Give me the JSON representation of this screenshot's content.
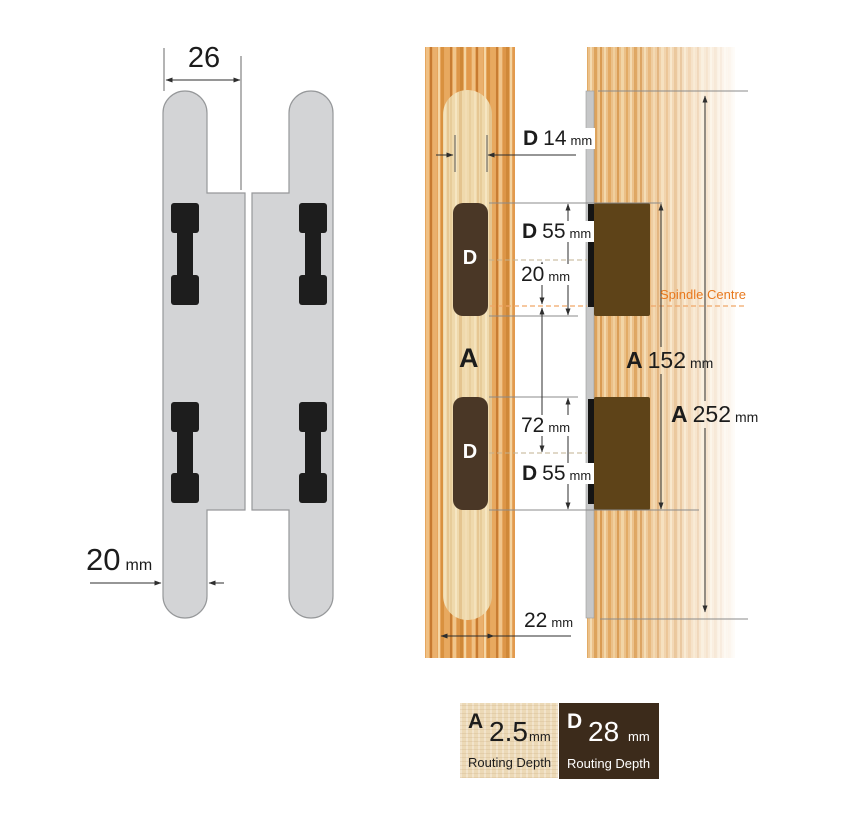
{
  "labels": {
    "hinge_width_top": {
      "value": "26"
    },
    "hinge_width_bottom": {
      "value": "20",
      "unit": "mm"
    },
    "pocket_width": {
      "prefix": "D",
      "value": "14",
      "unit": "mm"
    },
    "pocket_height_top": {
      "prefix": "D",
      "value": "55",
      "unit": "mm"
    },
    "centre_to_spindle": {
      "value": "20",
      "unit": "mm"
    },
    "spindle_centre": {
      "text": "Spindle Centre"
    },
    "frame_routing": {
      "value": "A"
    },
    "door_routing_inner": {
      "prefix": "A",
      "value": "152",
      "unit": "mm"
    },
    "spindle_to_lower_centre": {
      "value": "72",
      "unit": "mm"
    },
    "pocket_height_bottom": {
      "prefix": "D",
      "value": "55",
      "unit": "mm"
    },
    "door_routing_outer": {
      "prefix": "A",
      "value": "252",
      "unit": "mm"
    },
    "channel_width": {
      "value": "22",
      "unit": "mm"
    },
    "pocket_top_label": {
      "value": "D"
    },
    "pocket_bottom_label": {
      "value": "D"
    }
  },
  "legend": {
    "a": {
      "letter": "A",
      "value": "2.5",
      "unit": "mm",
      "caption": "Routing Depth"
    },
    "d": {
      "letter": "D",
      "value": "28",
      "unit": "mm",
      "caption": "Routing Depth"
    }
  },
  "colors": {
    "hinge_gray": "#d3d4d6",
    "clip_black": "#1d1d1d",
    "frame_wood": "#e6a75f",
    "routed_channel": "#efd9ac",
    "door_wood": "#ebc088",
    "pocket_brown": "#4a3726",
    "hinge_block_brown": "#5e4318",
    "hinge_edge_silver": "#c6c7c8",
    "legend_dark_brown": "#3c2b1b",
    "legend_light": "#ecd9b6",
    "spindle_orange": "#e8791e",
    "dimension_line": "#2e2e2e"
  }
}
